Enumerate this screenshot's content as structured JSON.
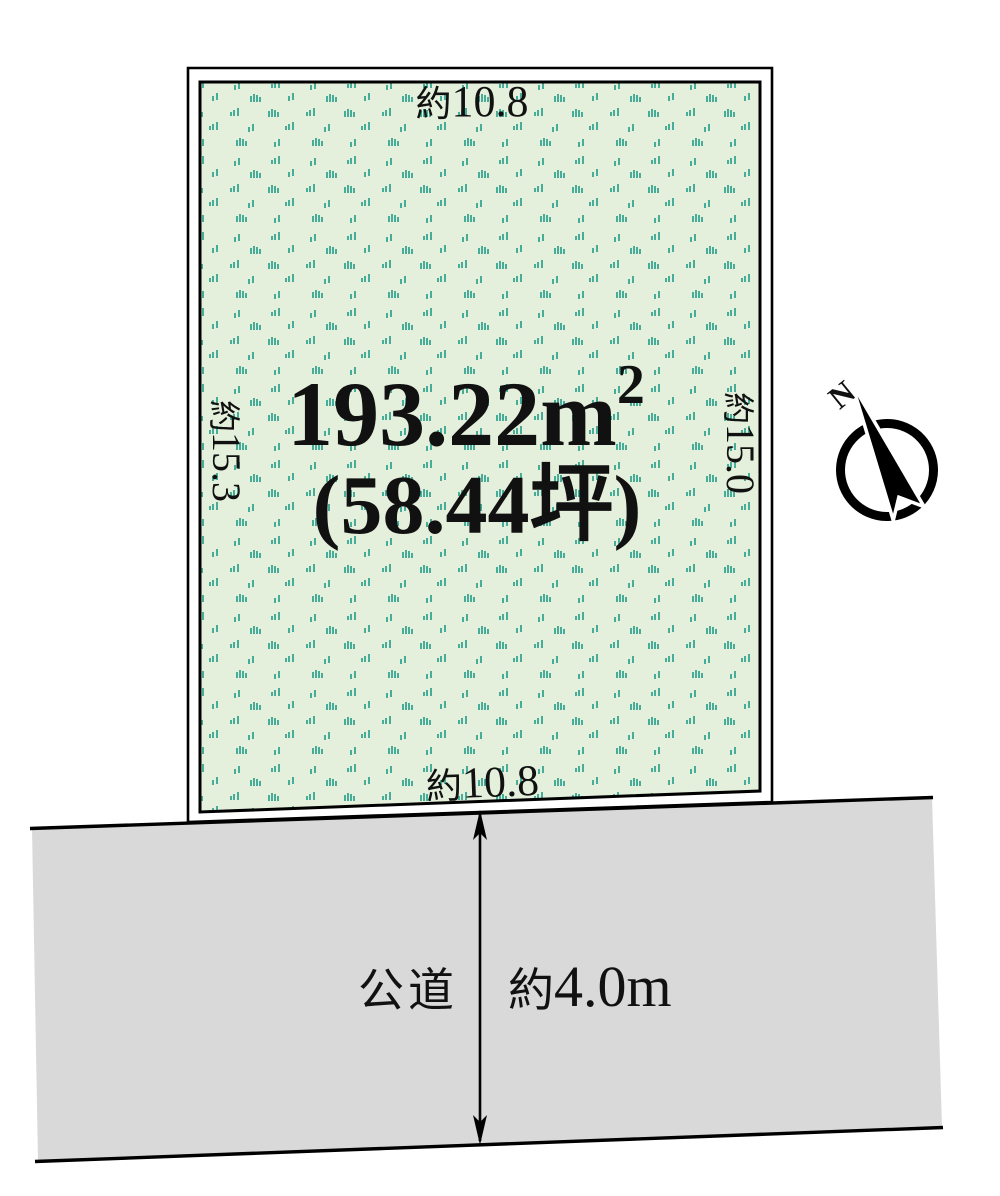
{
  "diagram": {
    "land_plot": {
      "area_main": "193.22m",
      "area_exponent": "2",
      "area_tsubo": "(58.44坪)",
      "dim_top": {
        "prefix": "約",
        "value": "10.8"
      },
      "dim_bottom": {
        "prefix": "約",
        "value": "10.8"
      },
      "dim_left": {
        "prefix": "約",
        "value": "15.3"
      },
      "dim_right": {
        "prefix": "約",
        "value": "15.0"
      },
      "fill_color": "#e5f0dc",
      "grass_color": "#47ad98",
      "border_color": "#000000"
    },
    "road": {
      "name": "公道",
      "width": {
        "prefix": "約",
        "value": "4.0m"
      },
      "fill_color": "#d9d9d9"
    },
    "compass": {
      "north": "N"
    }
  }
}
